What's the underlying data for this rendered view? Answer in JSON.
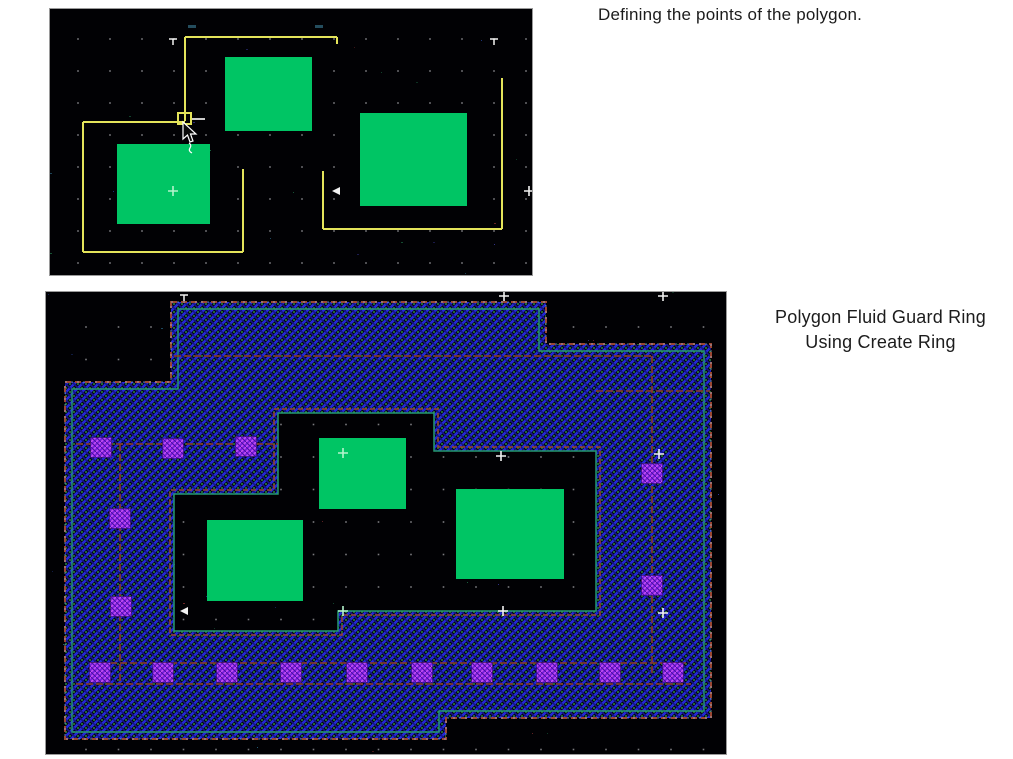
{
  "captions": {
    "defining": "Defining the points of the polygon.",
    "ring_line1": "Polygon Fluid Guard Ring",
    "ring_line2": "Using Create Ring"
  },
  "colors": {
    "page_bg": "#ffffff",
    "canvas_bg": "#010104",
    "canvas_border": "#9a9a9a",
    "grid_dot": "#8f8f94",
    "shape_green": "#00c564",
    "polygon_yellow": "#e3e35a",
    "hatch_blue": "#2429d8",
    "hatch_blue_dark": "#15168a",
    "hatch_green": "#2fa04a",
    "boundary_maroon": "#9a4632",
    "boundary_teal": "#259970",
    "boundary_cyan": "#9fd2ff",
    "centerline_red": "#8a3a26",
    "contact_purple": "#7a1fe0",
    "contact_stripe": "#c24df2",
    "contact_dark": "#4a0fa0",
    "marker_white": "#f2f2f2",
    "marker_green": "#b4f4cc",
    "caption_text": "#1c1c1c"
  },
  "top_canvas": {
    "x": 49,
    "y": 8,
    "width": 482,
    "height": 266,
    "grid": {
      "ox": 28,
      "oy": 30,
      "step": 32
    },
    "green_rects": [
      [
        175,
        48,
        87,
        74
      ],
      [
        67,
        135,
        93,
        80
      ],
      [
        310,
        104,
        107,
        93
      ]
    ],
    "yellow_segments": [
      [
        135,
        28,
        135,
        112
      ],
      [
        135,
        28,
        287,
        28
      ],
      [
        287,
        28,
        287,
        35
      ],
      [
        33,
        113,
        135,
        113
      ],
      [
        33,
        113,
        33,
        243
      ],
      [
        33,
        243,
        193,
        243
      ],
      [
        193,
        243,
        193,
        160
      ],
      [
        273,
        162,
        273,
        220
      ],
      [
        273,
        220,
        452,
        220
      ],
      [
        452,
        220,
        452,
        69
      ]
    ],
    "white_stub": [
      141,
      110,
      155,
      110
    ],
    "vertex_box": [
      128,
      104,
      13,
      11
    ],
    "markers": [
      {
        "type": "tee",
        "x": 123,
        "y": 30,
        "color": "white"
      },
      {
        "type": "tee",
        "x": 444,
        "y": 30,
        "color": "white"
      },
      {
        "type": "smudge",
        "x": 138,
        "y": 16,
        "color": "cyan"
      },
      {
        "type": "smudge",
        "x": 265,
        "y": 16,
        "color": "cyan"
      },
      {
        "type": "plus",
        "x": 123,
        "y": 182,
        "color": "green"
      },
      {
        "type": "arrow-left",
        "x": 285,
        "y": 182,
        "color": "white"
      },
      {
        "type": "plus",
        "x": 479,
        "y": 182,
        "color": "white"
      }
    ],
    "cursor": {
      "x": 133,
      "y": 113
    }
  },
  "bottom_canvas": {
    "x": 45,
    "y": 291,
    "width": 680,
    "height": 462,
    "grid": {
      "ox": 40,
      "oy": 35,
      "step": 32.5
    },
    "ring": {
      "exterior": [
        [
          125,
          10
        ],
        [
          500,
          10
        ],
        [
          500,
          52
        ],
        [
          665,
          52
        ],
        [
          665,
          426
        ],
        [
          400,
          426
        ],
        [
          400,
          447
        ],
        [
          19,
          447
        ],
        [
          19,
          90
        ],
        [
          125,
          90
        ]
      ],
      "teal_inset": [
        [
          132,
          17
        ],
        [
          493,
          17
        ],
        [
          493,
          59
        ],
        [
          658,
          59
        ],
        [
          658,
          419
        ],
        [
          393,
          419
        ],
        [
          393,
          440
        ],
        [
          26,
          440
        ],
        [
          26,
          97
        ],
        [
          132,
          97
        ]
      ],
      "hole": [
        [
          232,
          121
        ],
        [
          388,
          121
        ],
        [
          388,
          159
        ],
        [
          550,
          159
        ],
        [
          550,
          319
        ],
        [
          292,
          319
        ],
        [
          292,
          339
        ],
        [
          128,
          339
        ],
        [
          128,
          202
        ],
        [
          232,
          202
        ]
      ],
      "hole_outer": [
        [
          228,
          117
        ],
        [
          392,
          117
        ],
        [
          392,
          155
        ],
        [
          554,
          155
        ],
        [
          554,
          323
        ],
        [
          296,
          323
        ],
        [
          296,
          343
        ],
        [
          124,
          343
        ],
        [
          124,
          198
        ],
        [
          228,
          198
        ]
      ]
    },
    "centerlines": [
      [
        128,
        64,
        606,
        64
      ],
      [
        550,
        99,
        664,
        99
      ],
      [
        606,
        64,
        606,
        381
      ],
      [
        30,
        152,
        232,
        152
      ],
      [
        74,
        152,
        74,
        392
      ],
      [
        44,
        371,
        640,
        371
      ],
      [
        30,
        392,
        645,
        392
      ]
    ],
    "contacts": {
      "size": 21,
      "centers": [
        [
          55,
          156
        ],
        [
          127,
          157
        ],
        [
          200,
          155
        ],
        [
          74,
          227
        ],
        [
          75,
          315
        ],
        [
          606,
          182
        ],
        [
          606,
          294
        ],
        [
          54,
          381
        ],
        [
          117,
          381
        ],
        [
          181,
          381
        ],
        [
          245,
          381
        ],
        [
          311,
          381
        ],
        [
          376,
          381
        ],
        [
          436,
          381
        ],
        [
          501,
          381
        ],
        [
          564,
          381
        ],
        [
          627,
          381
        ]
      ]
    },
    "green_rects": [
      [
        273,
        146,
        87,
        71
      ],
      [
        161,
        228,
        96,
        81
      ],
      [
        410,
        197,
        108,
        90
      ]
    ],
    "markers": [
      {
        "type": "tee",
        "x": 138,
        "y": 3,
        "color": "white"
      },
      {
        "type": "plus",
        "x": 458,
        "y": 4,
        "color": "white"
      },
      {
        "type": "plus",
        "x": 617,
        "y": 4,
        "color": "white"
      },
      {
        "type": "plus",
        "x": 613,
        "y": 162,
        "color": "white"
      },
      {
        "type": "plus",
        "x": 455,
        "y": 164,
        "color": "white"
      },
      {
        "type": "plus",
        "x": 297,
        "y": 161,
        "color": "green"
      },
      {
        "type": "plus",
        "x": 457,
        "y": 319,
        "color": "white"
      },
      {
        "type": "plus",
        "x": 617,
        "y": 321,
        "color": "white"
      },
      {
        "type": "plus",
        "x": 297,
        "y": 319,
        "color": "green"
      },
      {
        "type": "arrow-left",
        "x": 137,
        "y": 319,
        "color": "white"
      }
    ]
  }
}
